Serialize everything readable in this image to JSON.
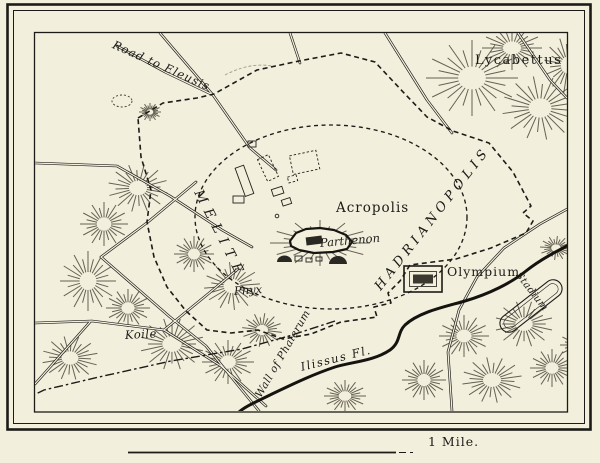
{
  "map": {
    "title_context": "Historic map of Athens",
    "labels": {
      "road_to_eleusis": "Road to Eleusis",
      "lycabettus": "Lycabettus",
      "melite": "MELITE",
      "acropolis": "Acropolis",
      "parthenon": "Parthenon",
      "hadrianopolis": "HADRIANOPOLIS",
      "olympium": "Olympium",
      "pnyx": "Pnyx",
      "koile": "Koile",
      "wall_of_phalerum": "Wall of Phalerum",
      "ilissus_fl": "Ilissus Fl.",
      "stadium": "Stadium"
    },
    "scale_bar": {
      "label": "1 Mile."
    },
    "colors": {
      "paper": "#f2efdd",
      "ink": "#1c1b17",
      "hachure": "#4e493b"
    }
  }
}
